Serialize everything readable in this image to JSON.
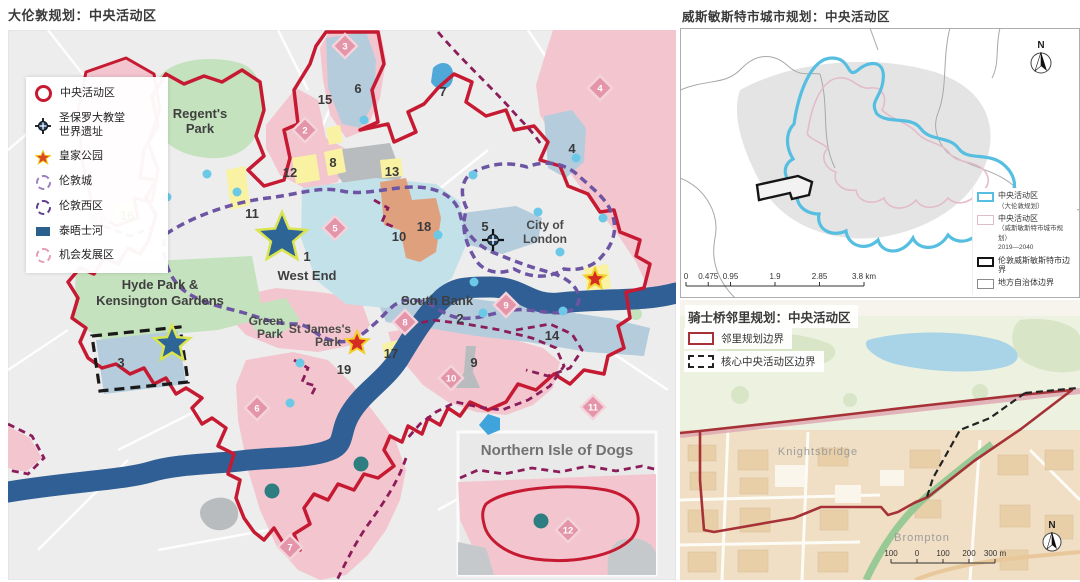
{
  "left_map": {
    "title": "大伦敦规划：中央活动区",
    "legend": {
      "items": [
        {
          "label": "中央活动区"
        },
        {
          "label": "圣保罗大教堂",
          "label2": "世界遗址"
        },
        {
          "label": "皇家公园"
        },
        {
          "label": "伦敦城"
        },
        {
          "label": "伦敦西区"
        },
        {
          "label": "泰晤士河"
        },
        {
          "label": "机会发展区"
        }
      ]
    },
    "places": {
      "regents_1": "Regent's",
      "regents_2": "Park",
      "hyde_1": "Hyde Park &",
      "hyde_2": "Kensington Gardens",
      "west_end_num": "1",
      "west_end": "West End",
      "green_1": "Green",
      "green_2": "Park",
      "stjames_1": "St James's",
      "stjames_2": "Park",
      "south_bank": "South Bank",
      "south_bank_num": "2",
      "city_1": "City of",
      "city_2": "London",
      "inset_title": "Northern Isle of Dogs"
    },
    "number_markers": [
      {
        "n": "1",
        "x": 299,
        "y": 231
      },
      {
        "n": "2",
        "x": 452,
        "y": 293
      },
      {
        "n": "3",
        "x": 113,
        "y": 337
      },
      {
        "n": "4",
        "x": 564,
        "y": 123
      },
      {
        "n": "5",
        "x": 477,
        "y": 201
      },
      {
        "n": "6",
        "x": 350,
        "y": 63
      },
      {
        "n": "7",
        "x": 435,
        "y": 66
      },
      {
        "n": "8",
        "x": 325,
        "y": 137
      },
      {
        "n": "9",
        "x": 466,
        "y": 337
      },
      {
        "n": "10",
        "x": 391,
        "y": 211
      },
      {
        "n": "11",
        "x": 244,
        "y": 188
      },
      {
        "n": "12",
        "x": 282,
        "y": 147
      },
      {
        "n": "13",
        "x": 384,
        "y": 146
      },
      {
        "n": "14",
        "x": 544,
        "y": 310
      },
      {
        "n": "15",
        "x": 317,
        "y": 74
      },
      {
        "n": "16",
        "x": 119,
        "y": 190
      },
      {
        "n": "17",
        "x": 383,
        "y": 328
      },
      {
        "n": "18",
        "x": 416,
        "y": 201
      },
      {
        "n": "19",
        "x": 336,
        "y": 344
      }
    ],
    "diamond_markers": [
      {
        "n": "1",
        "x": 90,
        "y": 189
      },
      {
        "n": "2",
        "x": 297,
        "y": 100
      },
      {
        "n": "3",
        "x": 337,
        "y": 16
      },
      {
        "n": "4",
        "x": 592,
        "y": 58
      },
      {
        "n": "5",
        "x": 327,
        "y": 198
      },
      {
        "n": "6",
        "x": 249,
        "y": 378
      },
      {
        "n": "7",
        "x": 282,
        "y": 517
      },
      {
        "n": "8",
        "x": 397,
        "y": 292
      },
      {
        "n": "9",
        "x": 498,
        "y": 275
      },
      {
        "n": "10",
        "x": 443,
        "y": 348
      },
      {
        "n": "11",
        "x": 585,
        "y": 377
      },
      {
        "n": "12",
        "x": 560,
        "y": 500
      }
    ],
    "stars": [
      {
        "kind": "blue",
        "x": 274,
        "y": 208,
        "r": 26
      },
      {
        "kind": "blue",
        "x": 164,
        "y": 314,
        "r": 19
      },
      {
        "kind": "red",
        "x": 349,
        "y": 313,
        "r": 12
      },
      {
        "kind": "red",
        "x": 587,
        "y": 249,
        "r": 11
      }
    ],
    "cyan_dots": [
      {
        "x": 199,
        "y": 144
      },
      {
        "x": 159,
        "y": 167
      },
      {
        "x": 229,
        "y": 162
      },
      {
        "x": 356,
        "y": 90
      },
      {
        "x": 465,
        "y": 145
      },
      {
        "x": 530,
        "y": 182
      },
      {
        "x": 552,
        "y": 222
      },
      {
        "x": 595,
        "y": 188
      },
      {
        "x": 568,
        "y": 128
      },
      {
        "x": 475,
        "y": 283
      },
      {
        "x": 555,
        "y": 281
      },
      {
        "x": 292,
        "y": 333
      },
      {
        "x": 282,
        "y": 373
      },
      {
        "x": 430,
        "y": 205
      },
      {
        "x": 466,
        "y": 252
      }
    ],
    "teal_dots": [
      {
        "x": 353,
        "y": 434
      },
      {
        "x": 264,
        "y": 461
      },
      {
        "x": 533,
        "y": 491
      }
    ],
    "colors": {
      "caz_red": "#C61A32",
      "opportunity_pink": "#F3C6CF",
      "diamond_pink": "#E495AA",
      "thames_blue": "#2F5F94",
      "park_green": "#C5E2BE",
      "west_end_purple": "#6D55A3",
      "magenta_dash": "#8C1D5B",
      "blue_star_fill": "#2D6596",
      "blue_star_edge": "#D9E44F",
      "red_star_fill": "#D52B20",
      "red_star_edge": "#F2CF2A",
      "cyan_dot": "#6BC8E6",
      "teal_dot": "#2E7D80"
    }
  },
  "westminster_map": {
    "title": "威斯敏斯特市城市规划：中央活动区",
    "north": "N",
    "legend": [
      {
        "label": "中央活动区",
        "sub": "（大伦敦规划）"
      },
      {
        "label": "中央活动区",
        "sub": "（威斯敏斯特市城市规划）",
        "sub2": "2019—2040"
      },
      {
        "label": "伦敦威斯敏斯特市边界"
      },
      {
        "label": "地方自治体边界"
      }
    ],
    "scale": {
      "ticks": [
        {
          "label": "0",
          "km": 0
        },
        {
          "label": "0.475",
          "km": 0.475
        },
        {
          "label": "0.95",
          "km": 0.95
        },
        {
          "label": "1.9",
          "km": 1.9
        },
        {
          "label": "2.85",
          "km": 2.85
        },
        {
          "label": "3.8 km",
          "km": 3.8
        }
      ]
    }
  },
  "knightsbridge_map": {
    "title": "骑士桥邻里规划：中央活动区",
    "north": "N",
    "legend": [
      {
        "label": "邻里规划边界"
      },
      {
        "label": "核心中央活动区边界"
      }
    ],
    "places": {
      "knightsbridge": "Knightsbridge",
      "brompton": "Brompton"
    },
    "scale": {
      "ticks": [
        {
          "label": "100",
          "m": -100
        },
        {
          "label": "0",
          "m": 0
        },
        {
          "label": "100",
          "m": 100
        },
        {
          "label": "200",
          "m": 200
        },
        {
          "label": "300 m",
          "m": 300
        }
      ]
    }
  }
}
